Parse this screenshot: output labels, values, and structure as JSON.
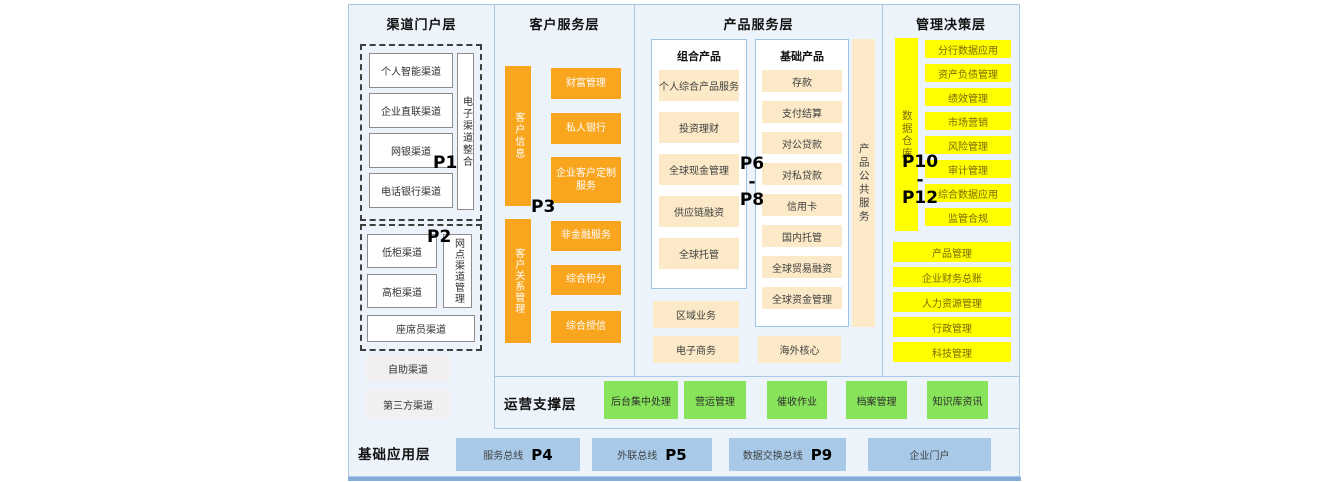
{
  "channel_layer": {
    "title": "渠道门户层",
    "group1": {
      "boxes": [
        "个人智能渠道",
        "企业直联渠道",
        "网银渠道",
        "电话银行渠道"
      ],
      "side_label": "电子渠道整合",
      "p_label": "P1"
    },
    "group2": {
      "boxes": [
        "低柜渠道",
        "高柜渠道"
      ],
      "side_label": "网点渠道管理",
      "bottom_box": "座席员渠道",
      "p_label": "P2"
    },
    "extra_boxes": [
      "自助渠道",
      "第三方渠道"
    ]
  },
  "customer_layer": {
    "title": "客户服务层",
    "p_label": "P3",
    "group1": {
      "bar": "客户信息",
      "boxes": [
        "财富管理",
        "私人银行",
        "企业客户定制服务"
      ]
    },
    "group2": {
      "bar": "客户关系管理",
      "boxes": [
        "非金融服务",
        "综合积分",
        "综合授信"
      ]
    }
  },
  "product_layer": {
    "title": "产品服务层",
    "p_label": {
      "top": "P6",
      "mid": "-",
      "bottom": "P8"
    },
    "combo": {
      "title": "组合产品",
      "boxes": [
        "个人综合产品服务",
        "投资理财",
        "全球现金管理",
        "供应链融资",
        "全球托管"
      ]
    },
    "basic": {
      "title": "基础产品",
      "boxes": [
        "存款",
        "支付结算",
        "对公贷款",
        "对私贷款",
        "信用卡",
        "国内托管",
        "全球贸易融资",
        "全球资金管理"
      ]
    },
    "side_bar": "产品公共服务",
    "extra": {
      "regional": "区域业务",
      "ecommerce": "电子商务",
      "overseas": "海外核心"
    }
  },
  "management_layer": {
    "title": "管理决策层",
    "p_label": {
      "top": "P10",
      "mid": "-",
      "bottom": "P12"
    },
    "bar": "数据仓库",
    "boxes": [
      "分行数据应用",
      "资产负债管理",
      "绩效管理",
      "市场营销",
      "风险管理",
      "审计管理",
      "综合数据应用",
      "监管合规"
    ],
    "wide_boxes": [
      "产品管理",
      "企业财务总账",
      "人力资源管理",
      "行政管理",
      "科技管理"
    ]
  },
  "operation_layer": {
    "title": "运营支撑层",
    "boxes": [
      "后台集中处理",
      "营运管理",
      "催收作业",
      "档案管理",
      "知识库资讯"
    ]
  },
  "foundation_layer": {
    "title": "基础应用层",
    "boxes": [
      {
        "label": "服务总线",
        "p": "P4"
      },
      {
        "label": "外联总线",
        "p": "P5"
      },
      {
        "label": "数据交换总线",
        "p": "P9"
      },
      {
        "label": "企业门户",
        "p": ""
      }
    ]
  },
  "colors": {
    "orange": "#F9A51D",
    "cream": "#FBE9C7",
    "yellow": "#FFFF00",
    "green": "#87E35A",
    "light_blue_box": "#A8CAE8",
    "panel_background": "#EDF3FB",
    "panel_border": "#A9C7E4",
    "bottom_bar": "#85ACD6"
  }
}
